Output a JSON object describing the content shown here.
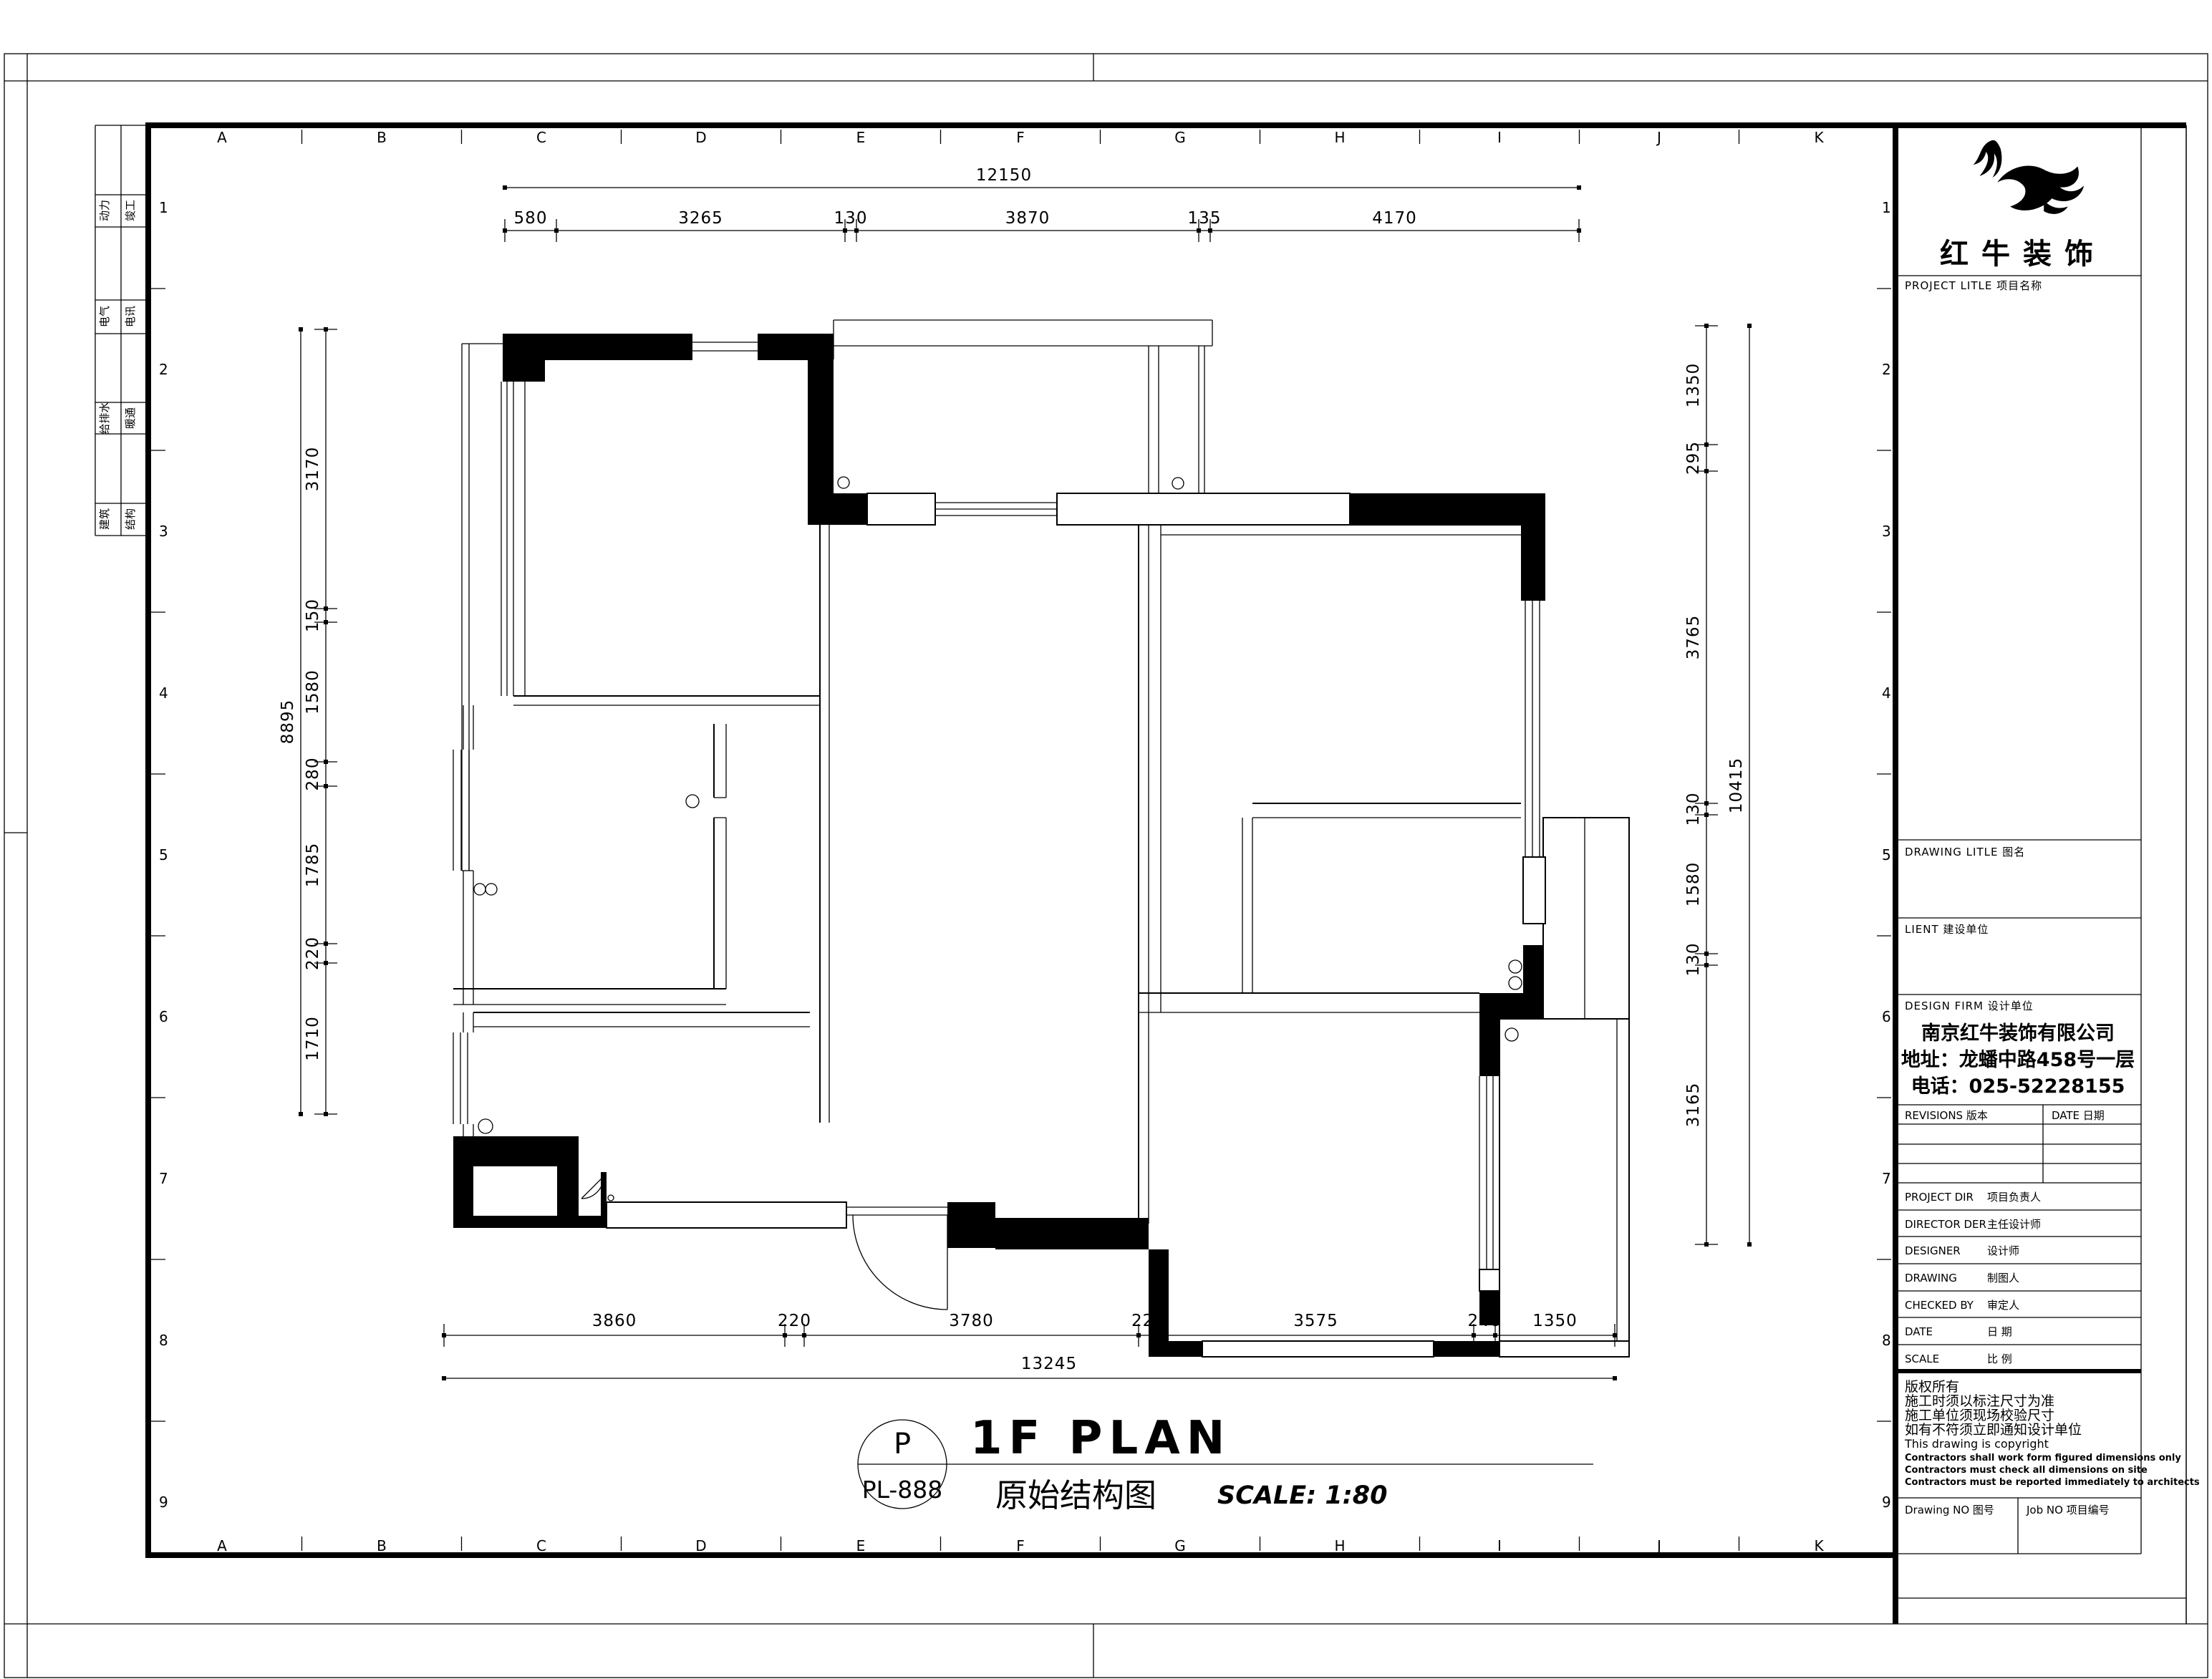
{
  "sheet": {
    "grid": {
      "letters": [
        "A",
        "B",
        "C",
        "D",
        "E",
        "F",
        "G",
        "H",
        "I",
        "J",
        "K"
      ],
      "numbers": [
        "1",
        "2",
        "3",
        "4",
        "5",
        "6",
        "7",
        "8",
        "9"
      ]
    },
    "signoff_rows": [
      {
        "left": "动力",
        "right": "竣工"
      },
      {
        "left": "电气",
        "right": "电讯"
      },
      {
        "left": "给排水",
        "right": "暖通"
      },
      {
        "left": "建筑",
        "right": "结构"
      }
    ]
  },
  "dimensions": {
    "top": {
      "total": "12150",
      "segments": [
        "580",
        "3265",
        "130",
        "3870",
        "135",
        "4170"
      ]
    },
    "bottom": {
      "total": "13245",
      "segments": [
        "3860",
        "220",
        "3780",
        "220",
        "3575",
        "240",
        "1350"
      ]
    },
    "left": {
      "total": "8895",
      "segments": [
        "3170",
        "150",
        "1580",
        "280",
        "1785",
        "220",
        "1710"
      ]
    },
    "right": {
      "total": "10415",
      "segments": [
        "1350",
        "295",
        "3765",
        "130",
        "1580",
        "130",
        "3165"
      ]
    }
  },
  "title": {
    "stamp_top": "P",
    "stamp_bottom": "PL-888",
    "main": "1F PLAN",
    "sub_cn": "原始结构图",
    "scale_note": "SCALE: 1:80"
  },
  "titleblock": {
    "brand": "红牛装饰",
    "project_title": "PROJECT LITLE  项目名称",
    "drawing_title": "DRAWING LITLE  图名",
    "client": "LIENT  建设单位",
    "design_firm": "DESIGN FIRM  设计单位",
    "company": {
      "name": "南京红牛装饰有限公司",
      "address": "地址：龙蟠中路458号一层",
      "phone": "电话：025-52228155"
    },
    "revisions": "REVISIONS  版本",
    "date_header": "DATE  日期",
    "rows": [
      {
        "en": "PROJECT DIR",
        "cn": "项目负责人"
      },
      {
        "en": "DIRECTOR DER",
        "cn": "主任设计师"
      },
      {
        "en": "DESIGNER",
        "cn": "设计师"
      },
      {
        "en": "DRAWING",
        "cn": "制图人"
      },
      {
        "en": "CHECKED BY",
        "cn": "审定人"
      },
      {
        "en": "DATE",
        "cn": "日  期"
      },
      {
        "en": "SCALE",
        "cn": "比  例"
      }
    ],
    "copyright": [
      "版权所有",
      "施工时须以标注尺寸为准",
      "施工单位须现场校验尺寸",
      "如有不符须立即通知设计单位",
      "This drawing is copyright",
      "Contractors shall work form figured dimensions only",
      "Contractors must check all dimensions on site",
      "Contractors must be reported immediately to architects"
    ],
    "drawing_no": "Drawing NO  图号",
    "job_no": "Job NO  项目编号"
  }
}
